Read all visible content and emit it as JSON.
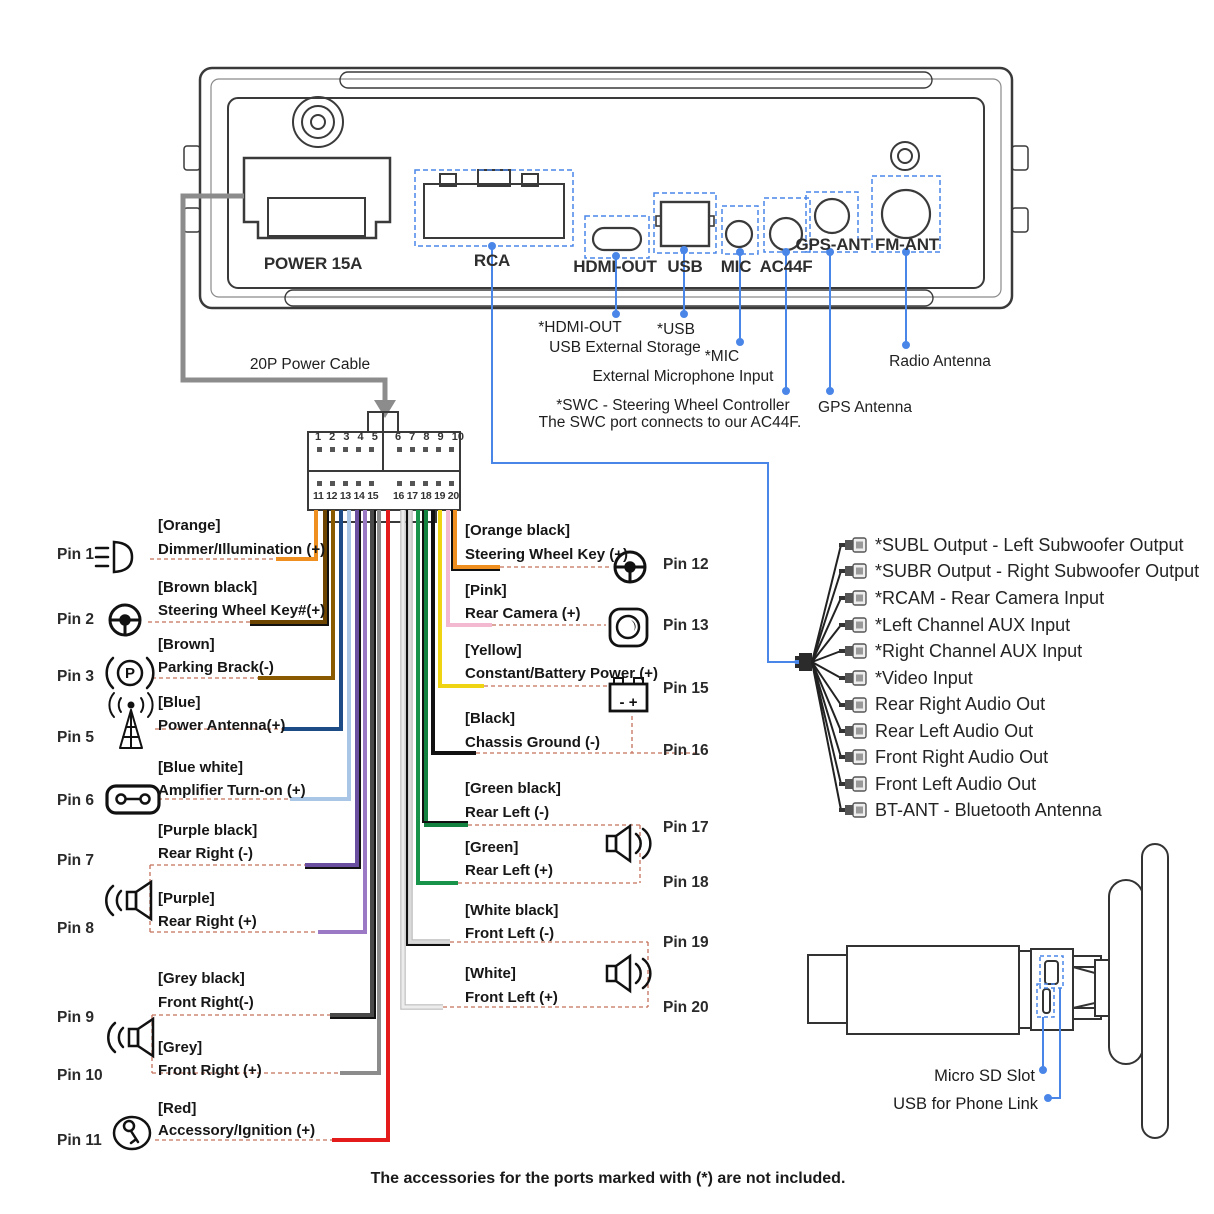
{
  "device_rear": {
    "port_labels": {
      "power": "POWER 15A",
      "rca": "RCA",
      "hdmi": "HDMI-OUT",
      "usb": "USB",
      "mic": "MIC",
      "ac44f": "AC44F",
      "gps_ant": "GPS-ANT",
      "fm_ant": "FM-ANT"
    },
    "callouts": {
      "hdmi": "*HDMI-OUT",
      "hdmi_sub": "USB External Storage",
      "usb": "*USB",
      "mic": "*MIC",
      "mic_sub": "External Microphone Input",
      "swc": "*SWC - Steering Wheel Controller",
      "swc_sub": "The SWC port connects to our AC44F.",
      "gps": "GPS Antenna",
      "radio": "Radio Antenna"
    },
    "accent_blue": "#4a86e8"
  },
  "harness": {
    "label": "20P Power Cable",
    "pin_numbers_top_left": "1 2 3 4 5",
    "pin_numbers_top_right": "6 7 8 9 10",
    "pin_numbers_bottom_left": "11 12 13 14 15",
    "pin_numbers_bottom_right": "16 17 18 19 20"
  },
  "pins_left": [
    {
      "pin": "Pin 1",
      "color_label": "[Orange]",
      "func": "Dimmer/Illumination (+)",
      "wire": "#ee8f1f",
      "icon": "headlight"
    },
    {
      "pin": "Pin 2",
      "color_label": "[Brown black]",
      "func": "Steering Wheel Key#(+)",
      "wire": "#6e4500",
      "icon": "steering-wheel"
    },
    {
      "pin": "Pin 3",
      "color_label": "[Brown]",
      "func": "Parking Brack(-)",
      "wire": "#8a5a00",
      "icon": "parking-brake"
    },
    {
      "pin": "Pin 5",
      "color_label": "[Blue]",
      "func": "Power Antenna(+)",
      "wire": "#1c4b85",
      "icon": "antenna"
    },
    {
      "pin": "Pin 6",
      "color_label": "[Blue white]",
      "func": "Amplifier Turn-on (+)",
      "wire": "#a9c6e7",
      "icon": "amplifier"
    },
    {
      "pin": "Pin 7",
      "color_label": "[Purple black]",
      "func": "Rear Right (-)",
      "wire": "#6a4fa0",
      "icon": "speaker"
    },
    {
      "pin": "Pin 8",
      "color_label": "[Purple]",
      "func": "Rear Right (+)",
      "wire": "#9b79c4",
      "icon": "speaker"
    },
    {
      "pin": "Pin 9",
      "color_label": "[Grey black]",
      "func": "Front Right(-)",
      "wire": "#4a4a4a",
      "icon": "speaker"
    },
    {
      "pin": "Pin 10",
      "color_label": "[Grey]",
      "func": "Front Right (+)",
      "wire": "#8c8c8c",
      "icon": "speaker"
    },
    {
      "pin": "Pin 11",
      "color_label": "[Red]",
      "func": "Accessory/Ignition (+)",
      "wire": "#e31b1b",
      "icon": "key"
    }
  ],
  "pins_right": [
    {
      "pin": "Pin 12",
      "color_label": "[Orange black]",
      "func": "Steering Wheel Key (+)",
      "wire": "#ee8f1f",
      "icon": "steering-wheel"
    },
    {
      "pin": "Pin 13",
      "color_label": "[Pink]",
      "func": "Rear Camera (+)",
      "wire": "#f2b9d0",
      "icon": "camera"
    },
    {
      "pin": "Pin 15",
      "color_label": "[Yellow]",
      "func": "Constant/Battery Power (+)",
      "wire": "#efd413",
      "icon": "battery"
    },
    {
      "pin": "Pin 16",
      "color_label": "[Black]",
      "func": "Chassis Ground (-)",
      "wire": "#111111",
      "icon": "none"
    },
    {
      "pin": "Pin 17",
      "color_label": "[Green black]",
      "func": "Rear Left (-)",
      "wire": "#13813f",
      "icon": "speaker"
    },
    {
      "pin": "Pin 18",
      "color_label": "[Green]",
      "func": "Rear Left (+)",
      "wire": "#17934a",
      "icon": "none"
    },
    {
      "pin": "Pin 19",
      "color_label": "[White black]",
      "func": "Front Left (-)",
      "wire": "#dadada",
      "icon": "speaker"
    },
    {
      "pin": "Pin 20",
      "color_label": "[White]",
      "func": "Front Left (+)",
      "wire": "#ececec",
      "icon": "none"
    }
  ],
  "rca_outputs": {
    "items": [
      "*SUBL Output - Left Subwoofer Output",
      "*SUBR Output - Right Subwoofer Output",
      "*RCAM - Rear Camera Input",
      "*Left Channel AUX Input",
      "*Right Channel AUX Input",
      "*Video Input",
      "Rear Right Audio Out",
      "Rear Left Audio Out",
      "Front Right Audio Out",
      "Front Left Audio Out",
      "BT-ANT - Bluetooth Antenna"
    ]
  },
  "rear_view": {
    "micro_sd": "Micro SD Slot",
    "usb_phone": "USB for Phone Link"
  },
  "battery_sign": "- +",
  "parking_letter": "P",
  "footnote": "The accessories for the ports marked with (*) are not included."
}
